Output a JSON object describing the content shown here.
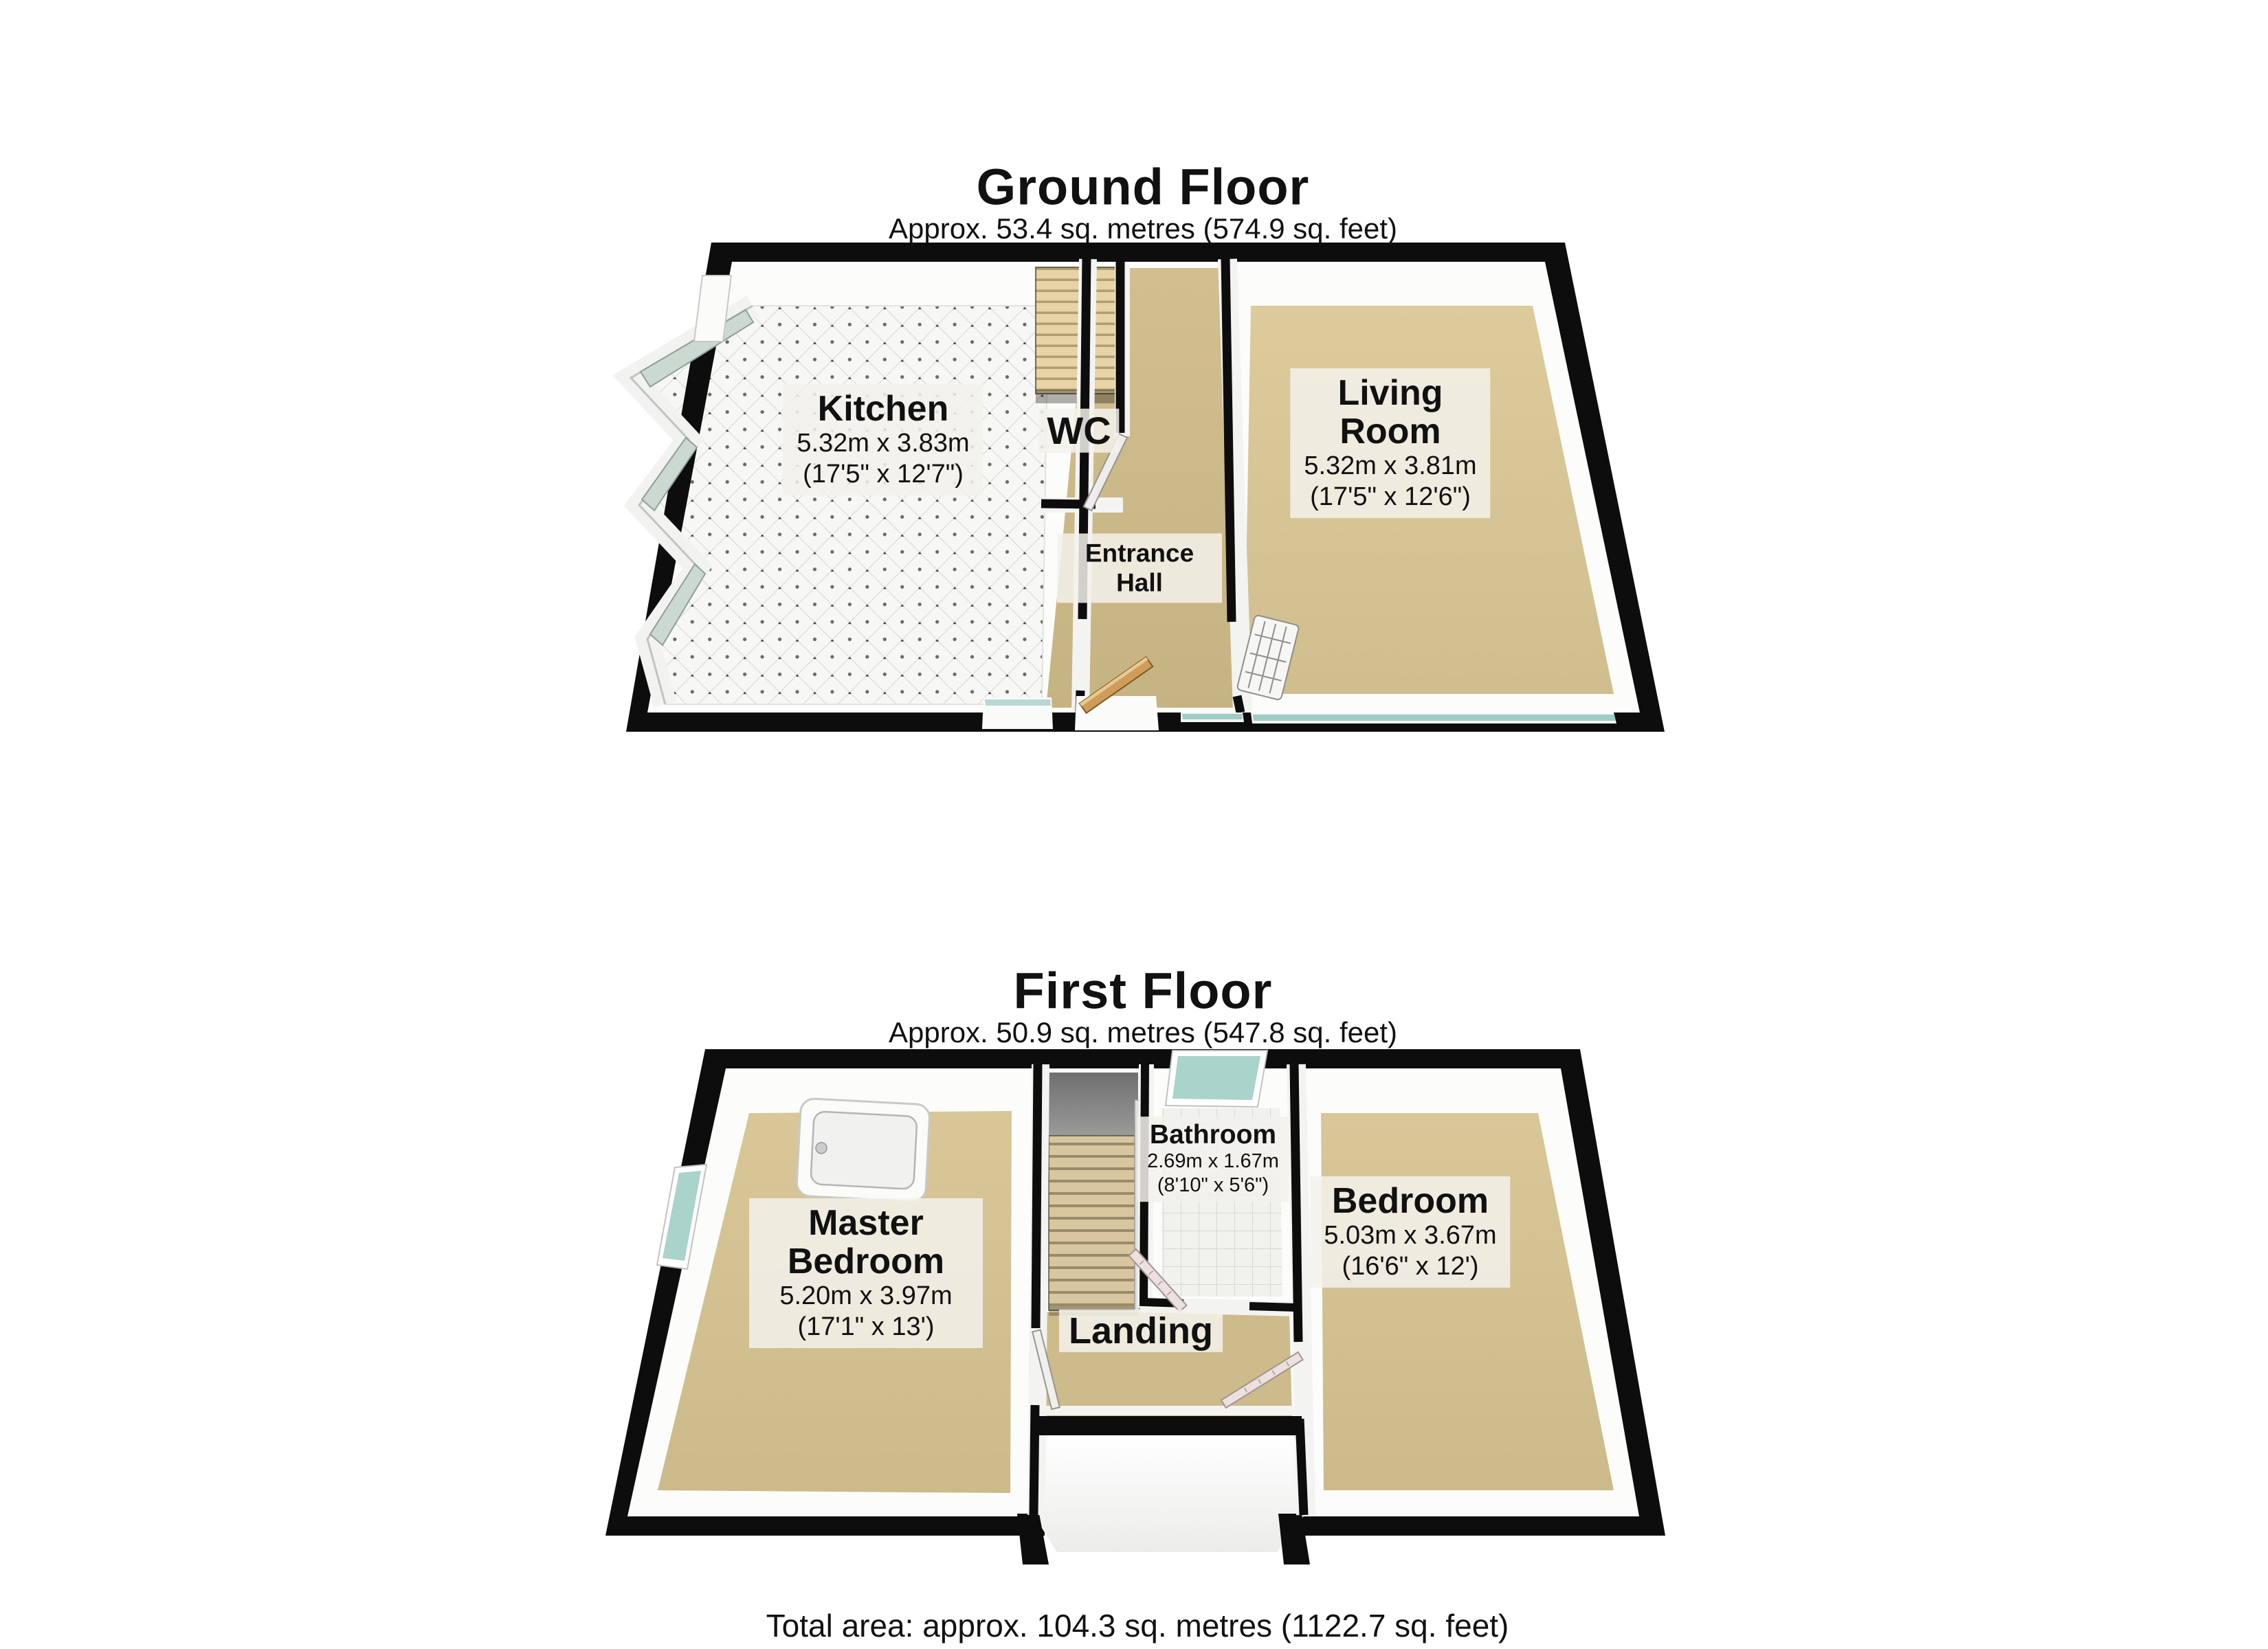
{
  "ground_floor": {
    "title": "Ground Floor",
    "area_label": "Approx. 53.4 sq. metres (574.9 sq. feet)",
    "rooms": {
      "kitchen": {
        "name": "Kitchen",
        "dims_metric": "5.32m x 3.83m",
        "dims_imperial": "(17'5\" x 12'7\")"
      },
      "wc": {
        "name": "WC"
      },
      "entrance_hall": {
        "name": "Entrance Hall"
      },
      "living_room": {
        "name": "Living Room",
        "dims_metric": "5.32m x 3.81m",
        "dims_imperial": "(17'5\" x 12'6\")"
      }
    }
  },
  "first_floor": {
    "title": "First Floor",
    "area_label": "Approx. 50.9 sq. metres (547.8 sq. feet)",
    "rooms": {
      "master_bedroom": {
        "name": "Master Bedroom",
        "dims_metric": "5.20m x 3.97m",
        "dims_imperial": "(17'1\" x 13')"
      },
      "bathroom": {
        "name": "Bathroom",
        "dims_metric": "2.69m x 1.67m",
        "dims_imperial": "(8'10\" x 5'6\")"
      },
      "bedroom": {
        "name": "Bedroom",
        "dims_metric": "5.03m x 3.67m",
        "dims_imperial": "(16'6\" x 12')"
      },
      "landing": {
        "name": "Landing"
      }
    }
  },
  "footer": {
    "total_area": "Total area: approx. 104.3 sq. metres (1122.7 sq. feet)"
  },
  "colors": {
    "wall": "#0d0d0d",
    "carpet_living": "#d7c596",
    "carpet_hall": "#cdb98a",
    "carpet_bedroom": "#d3c190",
    "kitchen_floor": "#f6f6f4",
    "bathroom_floor": "#f1f1ee",
    "window_glass_teal": "#a9d3cb",
    "bay_window_glass": "#ccd9d0",
    "front_door_wood": "#cf9c5a",
    "stairs_ground": "#e6d4a6",
    "stairs_first": "#d8c79e",
    "stairwell_gray": "#8c8c8c",
    "label_background": "#f3f1eb"
  }
}
